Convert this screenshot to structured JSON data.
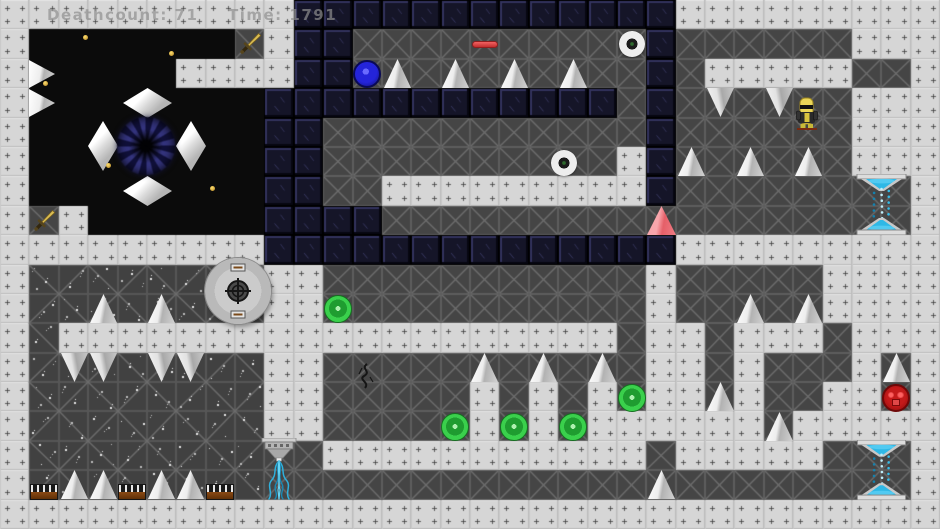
{
  "hud": {
    "deathcount": "Deathcount: 71",
    "time": "Time: 1791"
  },
  "palette": {
    "light_tile": "#d6d6d6",
    "dark_tile": "#454545",
    "navy_tile": "#151528",
    "black_void": "#0b0b0b",
    "spike_white": "#ededed",
    "orb_green": "#3ad04c",
    "orb_blue": "#2424da",
    "orb_red": "#c41a1a",
    "beam_cyan": "#35bce8",
    "gold": "#d8b84a",
    "hazard_salmon": "#e55f68",
    "wood_brown": "#8a4a14"
  },
  "level": {
    "cols": 32,
    "rows": 18,
    "legend": {
      "L": "light-plate-tile",
      "D": "dark-x-tile",
      "N": "navy-block-tile",
      "B": "black-void",
      "S": "dark-speckled-tile"
    },
    "grid": [
      "LLLLLLLLLLNNNNNNNNNNNNNLLLLLLLLL",
      "LBBBBBBBDLNNDDDDDDDDDDNDDDDDDLLL",
      "LBBBBBLLLLNNDDDDDDDDDDNDLLLLLDDL",
      "LBBBBBBBBNNNNNNNNNNNNDNDDDDDDLLL",
      "LBBBBBBBBNNDDDDDDDDDDDNDDDDDDLLL",
      "LBBBBBBBBNNDDDDDDDDDDLNDDDDDDLLL",
      "LBBBBBBBBNNDDLLLLLLLLLNDDDDDDDDL",
      "LDLBBBBBBNNNNDDDDDDDDDDDDDDDDDDL",
      "LLLLLLLLLNNNNNNNNNNNNNNLLLLLLLLL",
      "LSSSSSSSSLLDDDDDDDDDDDLDDDDDLLLL",
      "LSSSSSSSSLLDDDDDDDDDDDLDDDDDLLLL",
      "LSLLLLLLLLLLLLLLLLLLLDLLDLLLDLLL",
      "LSSSSSSSSLLDDDDDDDDDDDLLDLDDDLDL",
      "LSSSSSSSSLLDDDDDLDLDLDLLDLDDLLDL",
      "LSSSSSSSSLLDDDDDLDLDLLLLLLDLLLLL",
      "LSSSSSSSSDDLLLLLLLLLLLDLLLLLDDDL",
      "LSSSSSSSSDDDDDDDDDDDDDDDDDDDDDDL",
      "LLLLLLLLLLLLLLLLLLLLLLLLLLLLLLLL"
    ]
  },
  "objects": [
    {
      "name": "white-spike",
      "type": "spike_up",
      "x": 384,
      "y": 59,
      "w": 27,
      "h": 29
    },
    {
      "name": "white-spike",
      "type": "spike_up",
      "x": 442,
      "y": 59,
      "w": 27,
      "h": 29
    },
    {
      "name": "white-spike",
      "type": "spike_up",
      "x": 501,
      "y": 59,
      "w": 27,
      "h": 29
    },
    {
      "name": "white-spike",
      "type": "spike_up",
      "x": 560,
      "y": 59,
      "w": 27,
      "h": 29
    },
    {
      "name": "white-spike",
      "type": "spike_up",
      "x": 678,
      "y": 147,
      "w": 27,
      "h": 29
    },
    {
      "name": "white-spike",
      "type": "spike_up",
      "x": 737,
      "y": 147,
      "w": 27,
      "h": 29
    },
    {
      "name": "white-spike",
      "type": "spike_up",
      "x": 795,
      "y": 147,
      "w": 27,
      "h": 29
    },
    {
      "name": "white-spike",
      "type": "spike_up",
      "x": 737,
      "y": 294,
      "w": 27,
      "h": 29
    },
    {
      "name": "white-spike",
      "type": "spike_up",
      "x": 795,
      "y": 294,
      "w": 27,
      "h": 29
    },
    {
      "name": "white-spike",
      "type": "spike_up",
      "x": 90,
      "y": 294,
      "w": 27,
      "h": 29
    },
    {
      "name": "white-spike",
      "type": "spike_up",
      "x": 148,
      "y": 294,
      "w": 27,
      "h": 29
    },
    {
      "name": "white-spike",
      "type": "spike_up",
      "x": 471,
      "y": 353,
      "w": 27,
      "h": 29
    },
    {
      "name": "white-spike",
      "type": "spike_up",
      "x": 530,
      "y": 353,
      "w": 27,
      "h": 29
    },
    {
      "name": "white-spike",
      "type": "spike_up",
      "x": 589,
      "y": 353,
      "w": 27,
      "h": 29
    },
    {
      "name": "white-spike",
      "type": "spike_up",
      "x": 707,
      "y": 382,
      "w": 27,
      "h": 29
    },
    {
      "name": "white-spike",
      "type": "spike_up",
      "x": 766,
      "y": 412,
      "w": 27,
      "h": 29
    },
    {
      "name": "white-spike",
      "type": "spike_up",
      "x": 883,
      "y": 353,
      "w": 27,
      "h": 29
    },
    {
      "name": "white-spike",
      "type": "spike_up",
      "x": 648,
      "y": 470,
      "w": 27,
      "h": 29
    },
    {
      "name": "white-spike",
      "type": "spike_up",
      "x": 61,
      "y": 470,
      "w": 27,
      "h": 29
    },
    {
      "name": "white-spike",
      "type": "spike_up",
      "x": 90,
      "y": 470,
      "w": 27,
      "h": 29
    },
    {
      "name": "white-spike",
      "type": "spike_up",
      "x": 148,
      "y": 470,
      "w": 27,
      "h": 29
    },
    {
      "name": "white-spike",
      "type": "spike_up",
      "x": 177,
      "y": 470,
      "w": 27,
      "h": 29
    },
    {
      "name": "ceiling-spike",
      "type": "spike_down",
      "x": 707,
      "y": 88,
      "w": 27,
      "h": 29
    },
    {
      "name": "ceiling-spike",
      "type": "spike_down",
      "x": 766,
      "y": 88,
      "w": 27,
      "h": 29
    },
    {
      "name": "ceiling-spike",
      "type": "spike_down",
      "x": 61,
      "y": 353,
      "w": 27,
      "h": 29
    },
    {
      "name": "ceiling-spike",
      "type": "spike_down",
      "x": 90,
      "y": 353,
      "w": 27,
      "h": 29
    },
    {
      "name": "ceiling-spike",
      "type": "spike_down",
      "x": 148,
      "y": 353,
      "w": 27,
      "h": 29
    },
    {
      "name": "ceiling-spike",
      "type": "spike_down",
      "x": 177,
      "y": 353,
      "w": 27,
      "h": 29
    },
    {
      "name": "wall-spike",
      "type": "spike_right",
      "x": 29,
      "y": 60,
      "w": 26,
      "h": 28
    },
    {
      "name": "wall-spike",
      "type": "spike_right",
      "x": 29,
      "y": 89,
      "w": 26,
      "h": 28
    },
    {
      "name": "white-diamond",
      "type": "diamond",
      "x": 123,
      "y": 88,
      "w": 49,
      "h": 30
    },
    {
      "name": "white-diamond",
      "type": "diamond",
      "x": 123,
      "y": 176,
      "w": 49,
      "h": 30
    },
    {
      "name": "white-diamond",
      "type": "diamond",
      "x": 88,
      "y": 121,
      "w": 30,
      "h": 50
    },
    {
      "name": "white-diamond",
      "type": "diamond",
      "x": 176,
      "y": 121,
      "w": 30,
      "h": 50
    },
    {
      "name": "black-hole-vortex",
      "type": "vortex",
      "x": 117,
      "y": 117,
      "w": 58,
      "h": 58
    },
    {
      "name": "gold-dot",
      "type": "dot",
      "x": 83,
      "y": 35,
      "w": 5,
      "h": 5
    },
    {
      "name": "gold-dot",
      "type": "dot",
      "x": 169,
      "y": 51,
      "w": 5,
      "h": 5
    },
    {
      "name": "gold-dot",
      "type": "dot",
      "x": 43,
      "y": 81,
      "w": 5,
      "h": 5
    },
    {
      "name": "gold-dot",
      "type": "dot",
      "x": 106,
      "y": 163,
      "w": 5,
      "h": 5
    },
    {
      "name": "gold-dot",
      "type": "dot",
      "x": 210,
      "y": 186,
      "w": 5,
      "h": 5
    },
    {
      "name": "gold-sword",
      "type": "sword",
      "x": 236,
      "y": 30,
      "w": 28,
      "h": 28
    },
    {
      "name": "gold-sword",
      "type": "sword",
      "x": 30,
      "y": 207,
      "w": 28,
      "h": 28
    },
    {
      "name": "blue-orb",
      "type": "ball_blue",
      "x": 353,
      "y": 60,
      "w": 28,
      "h": 28
    },
    {
      "name": "red-pill",
      "type": "pill",
      "x": 472,
      "y": 41,
      "w": 26,
      "h": 7
    },
    {
      "name": "gray-disc",
      "type": "disc",
      "x": 619,
      "y": 31,
      "w": 26,
      "h": 26
    },
    {
      "name": "gray-disc",
      "type": "disc",
      "x": 551,
      "y": 150,
      "w": 26,
      "h": 26
    },
    {
      "name": "red-spike-triangle",
      "type": "tri_red",
      "x": 647,
      "y": 206,
      "w": 29,
      "h": 29
    },
    {
      "name": "teleporter-beam",
      "type": "hourglass",
      "x": 853,
      "y": 174,
      "w": 57,
      "h": 61
    },
    {
      "name": "teleporter-beam",
      "type": "hourglass",
      "x": 853,
      "y": 440,
      "w": 57,
      "h": 60
    },
    {
      "name": "cannon-turret",
      "type": "turret",
      "x": 205,
      "y": 258,
      "w": 66,
      "h": 66
    },
    {
      "name": "green-orb",
      "type": "ball_green",
      "x": 324,
      "y": 295,
      "w": 28,
      "h": 28
    },
    {
      "name": "green-orb",
      "type": "ball_green",
      "x": 441,
      "y": 413,
      "w": 28,
      "h": 28
    },
    {
      "name": "green-orb",
      "type": "ball_green",
      "x": 500,
      "y": 413,
      "w": 28,
      "h": 28
    },
    {
      "name": "green-orb",
      "type": "ball_green",
      "x": 559,
      "y": 413,
      "w": 28,
      "h": 28
    },
    {
      "name": "green-orb",
      "type": "ball_green",
      "x": 618,
      "y": 384,
      "w": 28,
      "h": 28
    },
    {
      "name": "red-face-orb",
      "type": "ball_red",
      "x": 882,
      "y": 384,
      "w": 28,
      "h": 28
    },
    {
      "name": "crack-decal",
      "type": "crack",
      "x": 353,
      "y": 362,
      "w": 26,
      "h": 28
    },
    {
      "name": "water-emitter",
      "type": "fountain",
      "x": 258,
      "y": 438,
      "w": 42,
      "h": 62
    },
    {
      "name": "conveyor-platform",
      "type": "platform",
      "x": 30,
      "y": 484,
      "w": 28,
      "h": 16
    },
    {
      "name": "conveyor-platform",
      "type": "platform",
      "x": 118,
      "y": 484,
      "w": 28,
      "h": 16
    },
    {
      "name": "conveyor-platform",
      "type": "platform",
      "x": 206,
      "y": 484,
      "w": 28,
      "h": 16
    },
    {
      "name": "player-character",
      "type": "player",
      "x": 794,
      "y": 97,
      "w": 26,
      "h": 34
    }
  ]
}
